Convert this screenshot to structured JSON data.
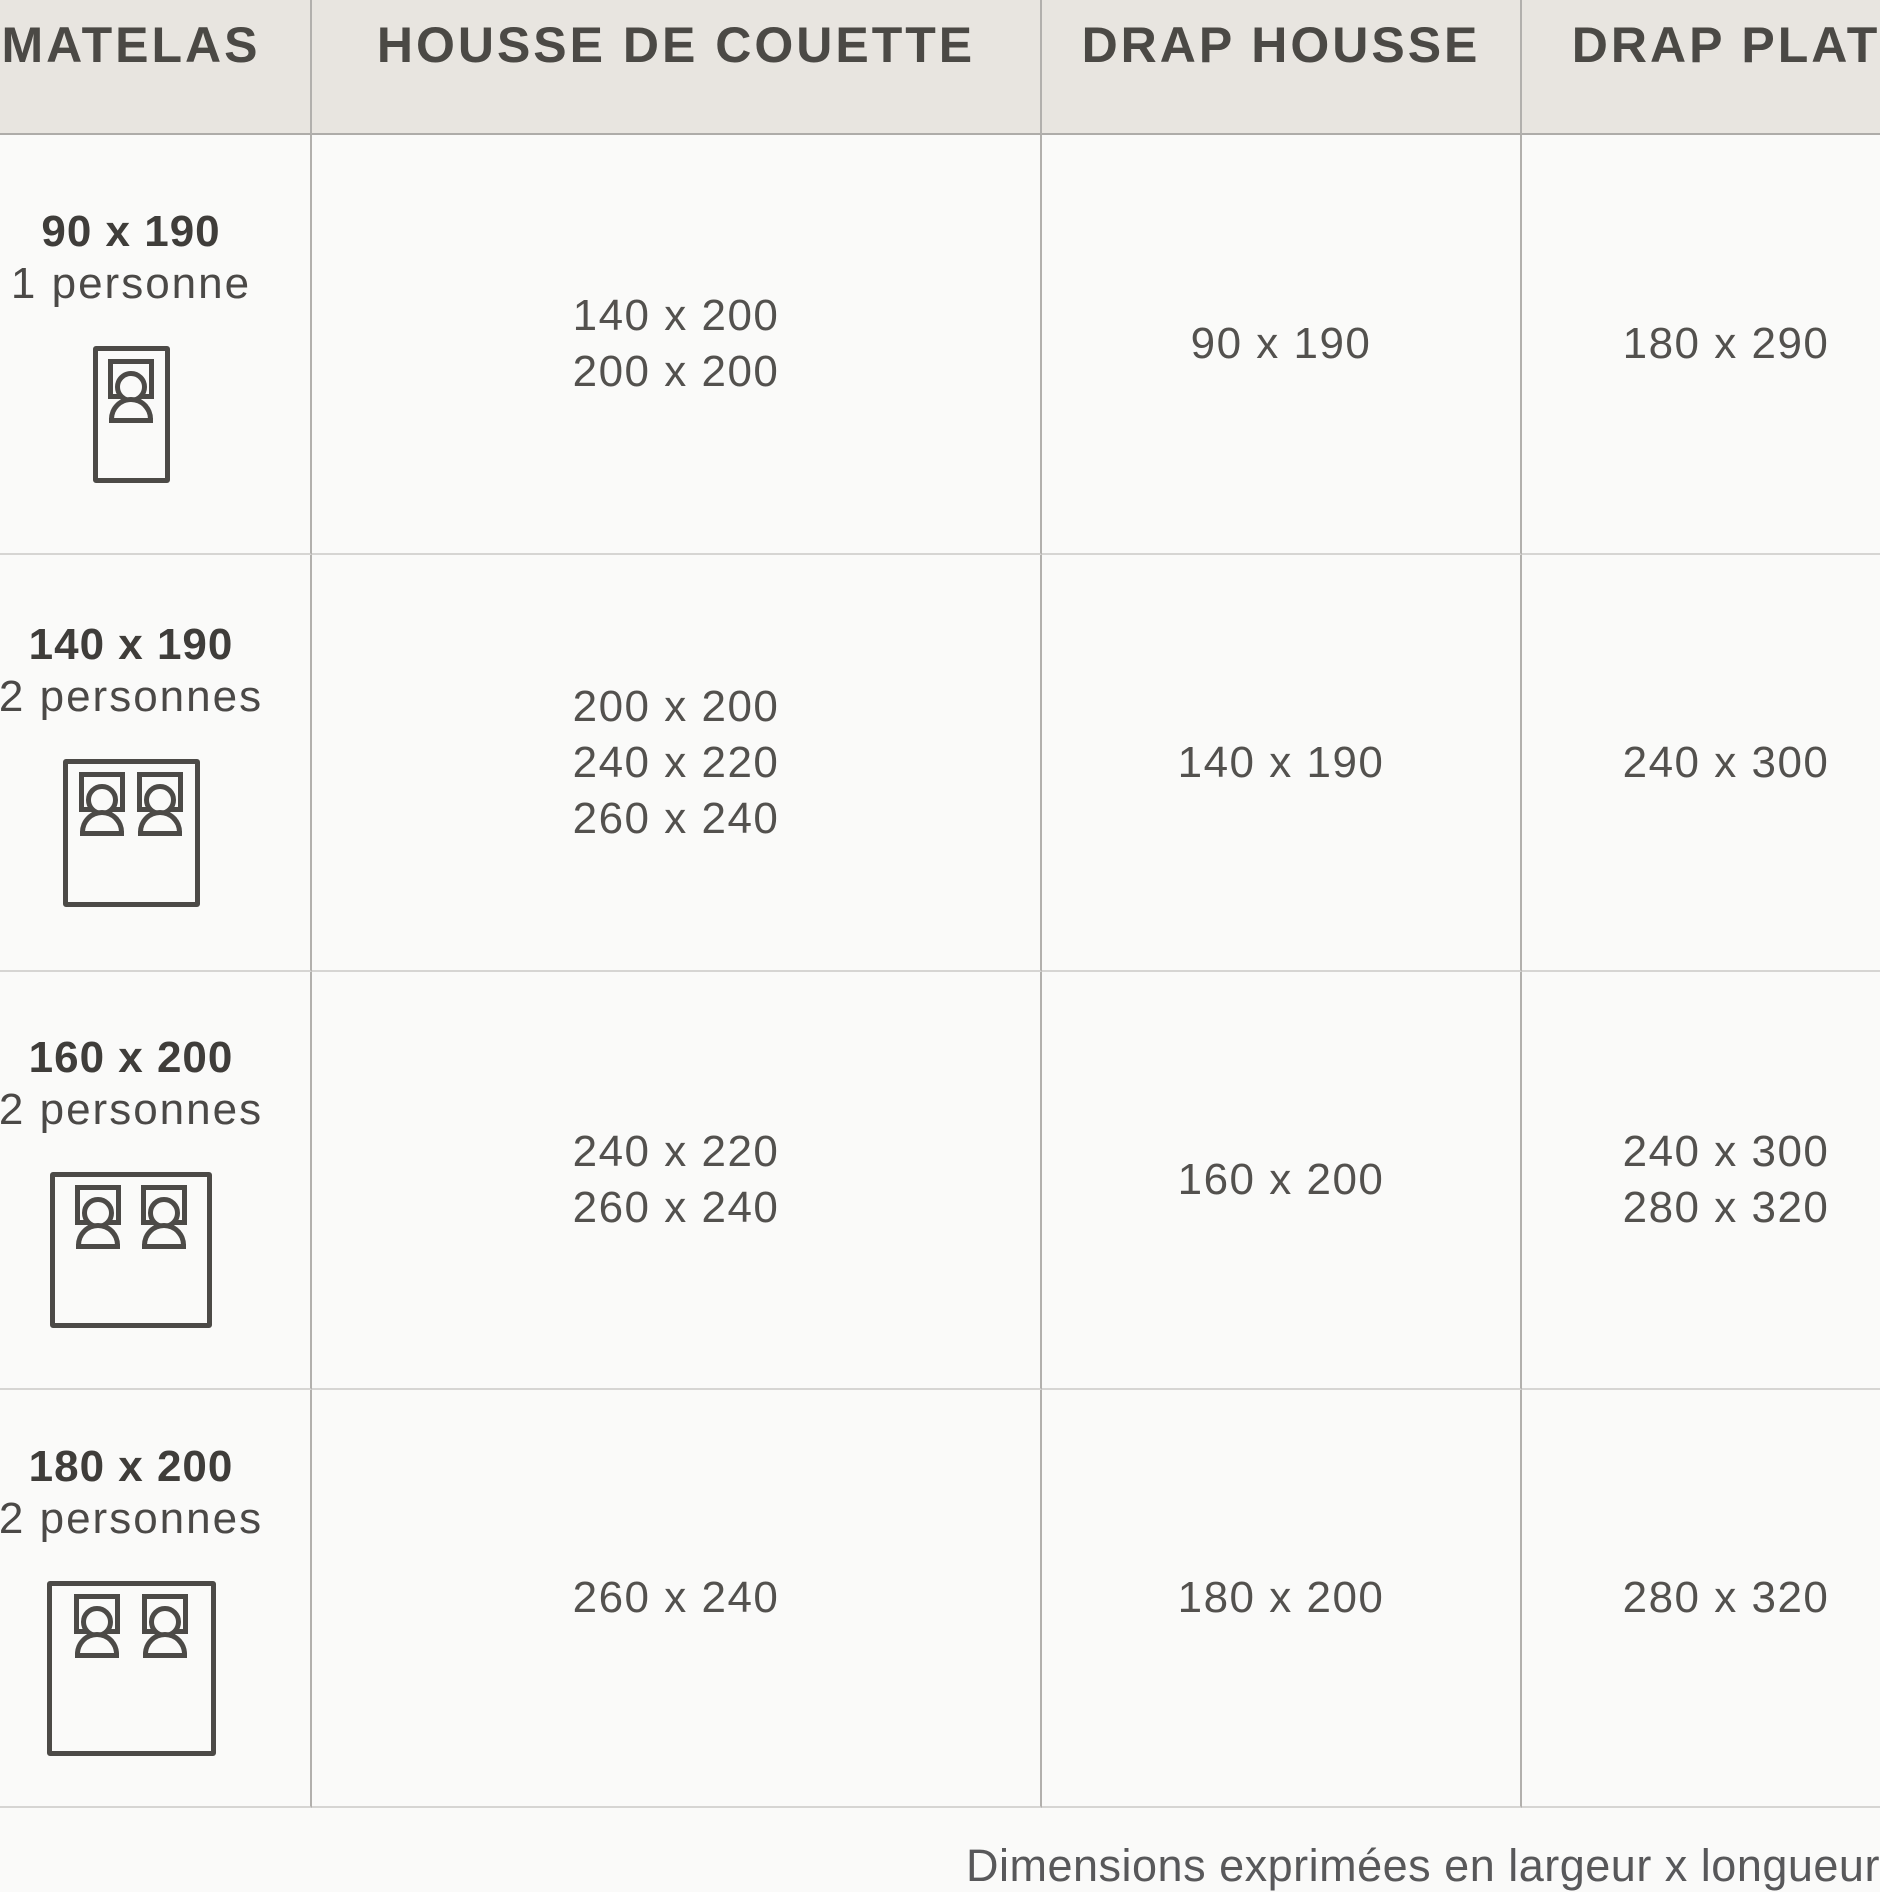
{
  "chart_data": {
    "type": "table",
    "columns": [
      "MATELAS",
      "HOUSSE DE COUETTE",
      "DRAP HOUSSE",
      "DRAP PLAT"
    ],
    "rows": [
      {
        "matelas_size": "90 x 190",
        "matelas_persons": "1 personne",
        "matelas_icon": "single-bed-icon",
        "housse_de_couette": [
          "140 x 200",
          "200 x 200"
        ],
        "drap_housse": [
          "90 x 190"
        ],
        "drap_plat": [
          "180 x 290"
        ]
      },
      {
        "matelas_size": "140 x 190",
        "matelas_persons": "2 personnes",
        "matelas_icon": "double-bed-icon",
        "housse_de_couette": [
          "200 x 200",
          "240 x 220",
          "260 x 240"
        ],
        "drap_housse": [
          "140 x 190"
        ],
        "drap_plat": [
          "240 x 300"
        ]
      },
      {
        "matelas_size": "160 x 200",
        "matelas_persons": "2 personnes",
        "matelas_icon": "double-bed-icon",
        "housse_de_couette": [
          "240 x 220",
          "260 x 240"
        ],
        "drap_housse": [
          "160 x 200"
        ],
        "drap_plat": [
          "240 x 300",
          "280 x 320"
        ]
      },
      {
        "matelas_size": "180 x 200",
        "matelas_persons": "2 personnes",
        "matelas_icon": "double-bed-icon",
        "housse_de_couette": [
          "260 x 240"
        ],
        "drap_housse": [
          "180 x 200"
        ],
        "drap_plat": [
          "280 x 320"
        ]
      }
    ],
    "footer_note": "Dimensions exprimées en largeur x longueur (cm",
    "units": "cm",
    "layout": {
      "grid": "on",
      "header_position": "top"
    }
  },
  "colors": {
    "header_bg": "#e8e5e0",
    "header_text": "#4b4945",
    "body_text": "#53514e",
    "bold_text": "#3f3d3a",
    "vertical_line": "#b2b0ad",
    "row_line": "#d6d5d3",
    "icon_stroke": "#4c4a47"
  }
}
